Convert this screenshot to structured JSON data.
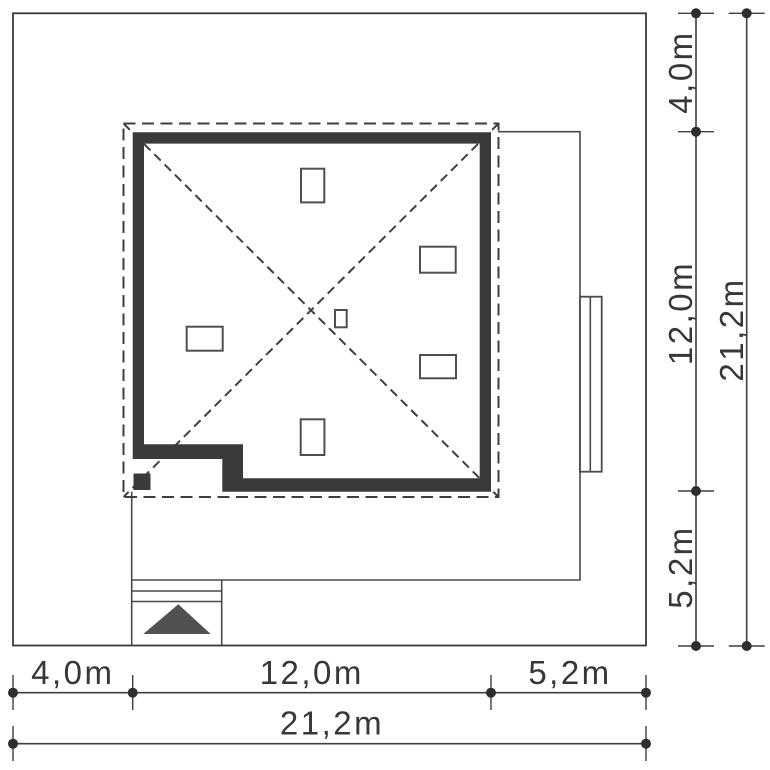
{
  "plan": {
    "unit": "m",
    "icons": {
      "entrance_arrow": "triangle-up"
    },
    "colors": {
      "wall": "#3a3a3a",
      "outline": "#4a4a4a",
      "dimension": "#3f3f3f",
      "text": "#373737",
      "entrance_arrow": "#515151",
      "background": "#ffffff"
    },
    "house": {
      "width_label": "12,0m",
      "depth_label": "12,0m"
    },
    "dimensions": {
      "right": {
        "segments": [
          {
            "label": "4,0m",
            "value": 4.0
          },
          {
            "label": "12,0m",
            "value": 12.0
          },
          {
            "label": "5,2m",
            "value": 5.2
          }
        ],
        "total": {
          "label": "21,2m",
          "value": 21.2
        }
      },
      "bottom": {
        "segments": [
          {
            "label": "4,0m",
            "value": 4.0
          },
          {
            "label": "12,0m",
            "value": 12.0
          },
          {
            "label": "5,2m",
            "value": 5.2
          }
        ],
        "total": {
          "label": "21,2m",
          "value": 21.2
        }
      }
    }
  }
}
